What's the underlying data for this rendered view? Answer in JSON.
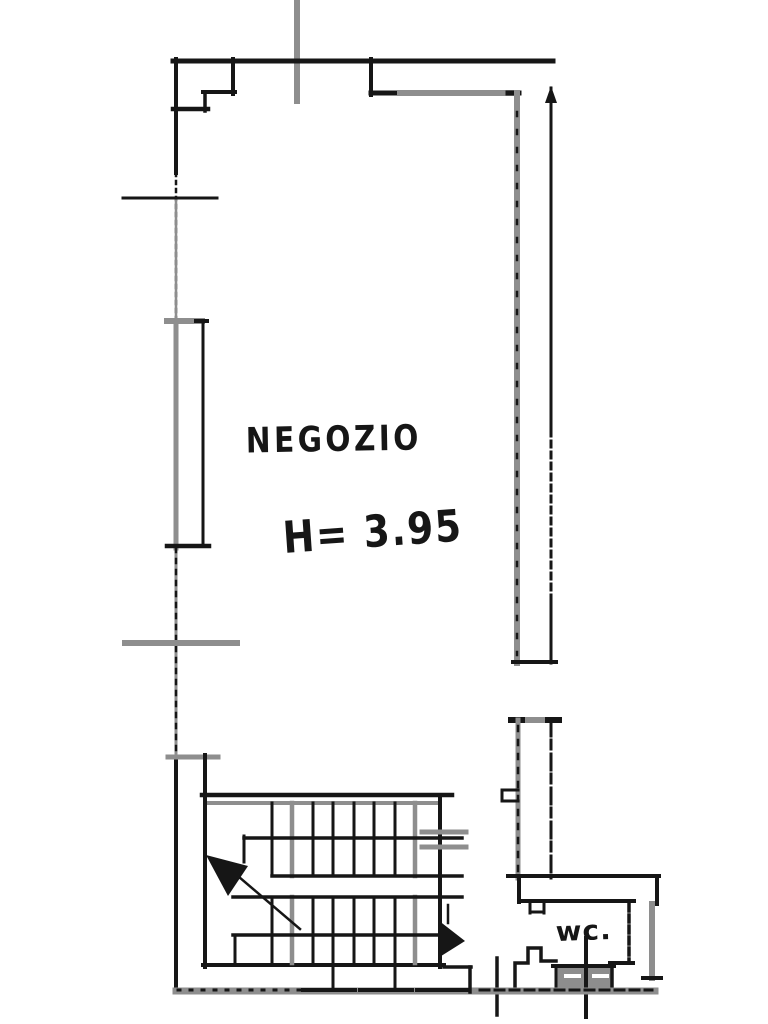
{
  "labels": {
    "room_name": "NEGOZIO",
    "height_note": "H= 3.95",
    "wc_label": "wc."
  },
  "colors": {
    "background": "#ffffff",
    "ink": "#161616",
    "pencil": "#8e8e8e",
    "fixture_fill": "#8d8d8d",
    "white": "#ffffff"
  },
  "floorplan": {
    "canvas": {
      "width": 768,
      "height": 1024
    },
    "rects": [
      {
        "n": "wc-fixture-hatch",
        "x": 556,
        "y": 966,
        "wd": 56,
        "h": 24,
        "f": "fixture_fill"
      }
    ],
    "polylines": [
      {
        "n": "wc-pedestal-outline",
        "pts": "515,992 515,963 528,963 528,948 541,948 541,961 556,961",
        "w": 3.5,
        "c": "ink"
      }
    ],
    "lines": [
      {
        "n": "site-ref-line",
        "x1": 297,
        "y1": 0,
        "x2": 297,
        "y2": 101,
        "w": 6,
        "c": "pencil"
      },
      {
        "n": "top-wall",
        "x1": 173,
        "y1": 61,
        "x2": 553,
        "y2": 61,
        "w": 5,
        "c": "ink"
      },
      {
        "n": "entry-step-v1",
        "x1": 233,
        "y1": 59,
        "x2": 233,
        "y2": 94,
        "w": 4,
        "c": "ink"
      },
      {
        "n": "entry-step-h1",
        "x1": 203,
        "y1": 92,
        "x2": 235,
        "y2": 92,
        "w": 4,
        "c": "ink"
      },
      {
        "n": "entry-step-v2",
        "x1": 205,
        "y1": 92,
        "x2": 205,
        "y2": 111,
        "w": 3.5,
        "c": "ink"
      },
      {
        "n": "entry-step-h2",
        "x1": 173,
        "y1": 109,
        "x2": 208,
        "y2": 109,
        "w": 4.5,
        "c": "ink"
      },
      {
        "n": "left-wall-upper",
        "x1": 176,
        "y1": 59,
        "x2": 176,
        "y2": 173,
        "w": 4,
        "c": "ink"
      },
      {
        "n": "left-wall-upper-dashed",
        "x1": 176,
        "y1": 173,
        "x2": 176,
        "y2": 322,
        "w": 2.5,
        "c": "ink",
        "d": "3,5"
      },
      {
        "n": "left-wall-upper-pencil",
        "x1": 176,
        "y1": 200,
        "x2": 176,
        "y2": 322,
        "w": 2.5,
        "c": "pencil"
      },
      {
        "n": "left-wall-window-run",
        "x1": 176,
        "y1": 322,
        "x2": 176,
        "y2": 548,
        "w": 5,
        "c": "pencil"
      },
      {
        "n": "left-wall-mid-pencil",
        "x1": 176,
        "y1": 548,
        "x2": 176,
        "y2": 758,
        "w": 3,
        "c": "pencil"
      },
      {
        "n": "left-wall-mid-dashed",
        "x1": 176,
        "y1": 548,
        "x2": 176,
        "y2": 758,
        "w": 2.5,
        "c": "ink",
        "d": "4,7"
      },
      {
        "n": "left-wall-lower",
        "x1": 176,
        "y1": 758,
        "x2": 176,
        "y2": 992,
        "w": 4,
        "c": "ink"
      },
      {
        "n": "left-tick-upper",
        "x1": 123,
        "y1": 198,
        "x2": 217,
        "y2": 198,
        "w": 3,
        "c": "ink",
        "d": "7,3,2,3"
      },
      {
        "n": "window-top",
        "x1": 167,
        "y1": 321,
        "x2": 202,
        "y2": 321,
        "w": 6,
        "c": "pencil"
      },
      {
        "n": "window-top-cap",
        "x1": 196,
        "y1": 321,
        "x2": 207,
        "y2": 321,
        "w": 4,
        "c": "ink"
      },
      {
        "n": "window-inner-line",
        "x1": 203,
        "y1": 321,
        "x2": 203,
        "y2": 545,
        "w": 3,
        "c": "ink",
        "d": "6,3"
      },
      {
        "n": "window-bottom",
        "x1": 167,
        "y1": 546,
        "x2": 209,
        "y2": 546,
        "w": 4.5,
        "c": "ink"
      },
      {
        "n": "left-tick-mid",
        "x1": 125,
        "y1": 643,
        "x2": 237,
        "y2": 643,
        "w": 6,
        "c": "pencil"
      },
      {
        "n": "left-tick-lower",
        "x1": 168,
        "y1": 757,
        "x2": 218,
        "y2": 757,
        "w": 5,
        "c": "pencil"
      },
      {
        "n": "left-pier-v",
        "x1": 205,
        "y1": 755,
        "x2": 205,
        "y2": 797,
        "w": 4,
        "c": "ink"
      },
      {
        "n": "top-right-corner-v",
        "x1": 371,
        "y1": 59,
        "x2": 371,
        "y2": 95,
        "w": 4,
        "c": "ink"
      },
      {
        "n": "top-right-wall-ink",
        "x1": 371,
        "y1": 93,
        "x2": 403,
        "y2": 93,
        "w": 5,
        "c": "ink"
      },
      {
        "n": "top-right-wall-pencil",
        "x1": 400,
        "y1": 93,
        "x2": 516,
        "y2": 93,
        "w": 6,
        "c": "pencil"
      },
      {
        "n": "top-right-wall-cap",
        "x1": 508,
        "y1": 93,
        "x2": 519,
        "y2": 93,
        "w": 5,
        "c": "ink"
      },
      {
        "n": "right-inner-wall",
        "x1": 517,
        "y1": 93,
        "x2": 517,
        "y2": 663,
        "w": 6,
        "c": "pencil"
      },
      {
        "n": "right-inner-wall-dashes",
        "x1": 517,
        "y1": 112,
        "x2": 517,
        "y2": 655,
        "w": 2.5,
        "c": "ink",
        "d": "4,14"
      },
      {
        "n": "right-outer-wall-upper",
        "x1": 551,
        "y1": 88,
        "x2": 551,
        "y2": 430,
        "w": 3,
        "c": "ink"
      },
      {
        "n": "right-outer-wall-mid",
        "x1": 551,
        "y1": 430,
        "x2": 551,
        "y2": 600,
        "w": 3,
        "c": "ink",
        "d": "6,5"
      },
      {
        "n": "right-outer-wall-lower",
        "x1": 551,
        "y1": 600,
        "x2": 551,
        "y2": 663,
        "w": 3,
        "c": "ink"
      },
      {
        "n": "right-wall-bottom-cap",
        "x1": 513,
        "y1": 662,
        "x2": 556,
        "y2": 662,
        "w": 4,
        "c": "ink"
      },
      {
        "n": "pilaster-cap",
        "x1": 511,
        "y1": 720,
        "x2": 559,
        "y2": 720,
        "w": 6,
        "c": "pencil"
      },
      {
        "n": "pilaster-cap-left",
        "x1": 511,
        "y1": 720,
        "x2": 522,
        "y2": 720,
        "w": 6,
        "c": "ink"
      },
      {
        "n": "pilaster-cap-right",
        "x1": 548,
        "y1": 720,
        "x2": 559,
        "y2": 720,
        "w": 6,
        "c": "ink"
      },
      {
        "n": "pilaster-left",
        "x1": 518,
        "y1": 720,
        "x2": 518,
        "y2": 878,
        "w": 5,
        "c": "pencil"
      },
      {
        "n": "pilaster-left-dashes",
        "x1": 518,
        "y1": 726,
        "x2": 518,
        "y2": 874,
        "w": 2.5,
        "c": "ink",
        "d": "5,9"
      },
      {
        "n": "pilaster-right",
        "x1": 551,
        "y1": 720,
        "x2": 551,
        "y2": 878,
        "w": 3,
        "c": "ink",
        "d": "16,4,9,5"
      },
      {
        "n": "pilaster-notch-top",
        "x1": 502,
        "y1": 790,
        "x2": 518,
        "y2": 790,
        "w": 3,
        "c": "ink"
      },
      {
        "n": "pilaster-notch-side",
        "x1": 502,
        "y1": 790,
        "x2": 502,
        "y2": 801,
        "w": 3,
        "c": "ink"
      },
      {
        "n": "pilaster-notch-bottom",
        "x1": 502,
        "y1": 801,
        "x2": 518,
        "y2": 801,
        "w": 3,
        "c": "ink"
      },
      {
        "n": "wc-wall-top",
        "x1": 508,
        "y1": 876,
        "x2": 659,
        "y2": 876,
        "w": 4,
        "c": "ink"
      },
      {
        "n": "wc-wall-right-end",
        "x1": 657,
        "y1": 876,
        "x2": 657,
        "y2": 904,
        "w": 4,
        "c": "ink"
      },
      {
        "n": "wc-wall-left-end",
        "x1": 519,
        "y1": 876,
        "x2": 519,
        "y2": 902,
        "w": 4,
        "c": "ink"
      },
      {
        "n": "wc-wall-bottom",
        "x1": 519,
        "y1": 901,
        "x2": 634,
        "y2": 901,
        "w": 4,
        "c": "ink"
      },
      {
        "n": "wc-notch-v1",
        "x1": 530,
        "y1": 901,
        "x2": 530,
        "y2": 913,
        "w": 3,
        "c": "ink"
      },
      {
        "n": "wc-notch-h",
        "x1": 530,
        "y1": 912,
        "x2": 544,
        "y2": 912,
        "w": 3,
        "c": "ink"
      },
      {
        "n": "wc-notch-v2",
        "x1": 544,
        "y1": 901,
        "x2": 544,
        "y2": 913,
        "w": 3,
        "c": "ink"
      },
      {
        "n": "right-lower-wall",
        "x1": 652,
        "y1": 904,
        "x2": 652,
        "y2": 978,
        "w": 6,
        "c": "pencil"
      },
      {
        "n": "right-lower-wall-tick",
        "x1": 643,
        "y1": 978,
        "x2": 661,
        "y2": 978,
        "w": 4,
        "c": "ink"
      },
      {
        "n": "wc-right-wall-dashed",
        "x1": 629,
        "y1": 904,
        "x2": 629,
        "y2": 962,
        "w": 3.5,
        "c": "ink",
        "d": "7,4"
      },
      {
        "n": "wc-bottom-right",
        "x1": 610,
        "y1": 963,
        "x2": 633,
        "y2": 963,
        "w": 4,
        "c": "ink"
      },
      {
        "n": "fixture-top-border",
        "x1": 553,
        "y1": 966,
        "x2": 614,
        "y2": 966,
        "w": 4,
        "c": "ink"
      },
      {
        "n": "fixture-left-border",
        "x1": 556,
        "y1": 966,
        "x2": 556,
        "y2": 990,
        "w": 3,
        "c": "ink"
      },
      {
        "n": "fixture-right-border",
        "x1": 612,
        "y1": 966,
        "x2": 612,
        "y2": 990,
        "w": 3.5,
        "c": "ink"
      },
      {
        "n": "fixture-dash-1",
        "x1": 566,
        "y1": 976,
        "x2": 579,
        "y2": 976,
        "w": 4,
        "c": "white"
      },
      {
        "n": "fixture-dash-2",
        "x1": 594,
        "y1": 976,
        "x2": 607,
        "y2": 976,
        "w": 4,
        "c": "white"
      },
      {
        "n": "wc-door-line",
        "x1": 586,
        "y1": 938,
        "x2": 586,
        "y2": 1017,
        "w": 4,
        "c": "ink"
      },
      {
        "n": "passage-jamb",
        "x1": 497,
        "y1": 958,
        "x2": 497,
        "y2": 1015,
        "w": 3.5,
        "c": "ink"
      },
      {
        "n": "bottom-wall",
        "x1": 176,
        "y1": 991,
        "x2": 655,
        "y2": 991,
        "w": 7,
        "c": "pencil"
      },
      {
        "n": "bottom-wall-ink-left",
        "x1": 178,
        "y1": 990,
        "x2": 300,
        "y2": 990,
        "w": 3,
        "c": "ink",
        "d": "2,10"
      },
      {
        "n": "bottom-wall-ink-mid",
        "x1": 303,
        "y1": 990,
        "x2": 472,
        "y2": 990,
        "w": 4,
        "c": "ink",
        "d": "30,4,18,5"
      },
      {
        "n": "bottom-wall-ink-right",
        "x1": 480,
        "y1": 990,
        "x2": 652,
        "y2": 990,
        "w": 3,
        "c": "ink",
        "d": "9,6"
      },
      {
        "n": "stair-top-wall",
        "x1": 202,
        "y1": 795,
        "x2": 452,
        "y2": 795,
        "w": 4.5,
        "c": "ink"
      },
      {
        "n": "stair-top-wall-pencil",
        "x1": 206,
        "y1": 803,
        "x2": 438,
        "y2": 803,
        "w": 4,
        "c": "pencil"
      },
      {
        "n": "stair-left-wall",
        "x1": 205,
        "y1": 795,
        "x2": 205,
        "y2": 967,
        "w": 4,
        "c": "ink"
      },
      {
        "n": "stair-right-wall",
        "x1": 440,
        "y1": 795,
        "x2": 440,
        "y2": 967,
        "w": 4,
        "c": "ink"
      },
      {
        "n": "stair-bottom-wall",
        "x1": 203,
        "y1": 965,
        "x2": 444,
        "y2": 965,
        "w": 4,
        "c": "ink"
      },
      {
        "n": "stair-bottom-step-h",
        "x1": 444,
        "y1": 967,
        "x2": 471,
        "y2": 967,
        "w": 3.5,
        "c": "ink"
      },
      {
        "n": "stair-bottom-step-v",
        "x1": 470,
        "y1": 967,
        "x2": 470,
        "y2": 992,
        "w": 3.5,
        "c": "ink"
      },
      {
        "n": "stair-tread-u1",
        "x1": 272,
        "y1": 803,
        "x2": 272,
        "y2": 876,
        "w": 3,
        "c": "ink"
      },
      {
        "n": "stair-tread-ug1",
        "x1": 292,
        "y1": 803,
        "x2": 292,
        "y2": 876,
        "w": 4.5,
        "c": "pencil"
      },
      {
        "n": "stair-tread-u2",
        "x1": 313,
        "y1": 803,
        "x2": 313,
        "y2": 876,
        "w": 3,
        "c": "ink"
      },
      {
        "n": "stair-tread-u3",
        "x1": 333,
        "y1": 803,
        "x2": 333,
        "y2": 876,
        "w": 3,
        "c": "ink"
      },
      {
        "n": "stair-tread-u4",
        "x1": 354,
        "y1": 803,
        "x2": 354,
        "y2": 876,
        "w": 3,
        "c": "ink"
      },
      {
        "n": "stair-tread-u5",
        "x1": 374,
        "y1": 803,
        "x2": 374,
        "y2": 876,
        "w": 3,
        "c": "ink"
      },
      {
        "n": "stair-tread-u6",
        "x1": 395,
        "y1": 803,
        "x2": 395,
        "y2": 876,
        "w": 3,
        "c": "ink"
      },
      {
        "n": "stair-tread-ug2",
        "x1": 415,
        "y1": 803,
        "x2": 415,
        "y2": 876,
        "w": 4.5,
        "c": "pencil"
      },
      {
        "n": "stair-tread-l1",
        "x1": 272,
        "y1": 897,
        "x2": 272,
        "y2": 963,
        "w": 3,
        "c": "ink"
      },
      {
        "n": "stair-tread-lg1",
        "x1": 292,
        "y1": 897,
        "x2": 292,
        "y2": 963,
        "w": 4.5,
        "c": "pencil"
      },
      {
        "n": "stair-tread-l2",
        "x1": 313,
        "y1": 897,
        "x2": 313,
        "y2": 963,
        "w": 3,
        "c": "ink"
      },
      {
        "n": "stair-tread-l3",
        "x1": 333,
        "y1": 897,
        "x2": 333,
        "y2": 963,
        "w": 3,
        "c": "ink"
      },
      {
        "n": "stair-tread-l4",
        "x1": 354,
        "y1": 897,
        "x2": 354,
        "y2": 963,
        "w": 3,
        "c": "ink"
      },
      {
        "n": "stair-tread-l5",
        "x1": 374,
        "y1": 897,
        "x2": 374,
        "y2": 963,
        "w": 3,
        "c": "ink"
      },
      {
        "n": "stair-tread-l6",
        "x1": 395,
        "y1": 897,
        "x2": 395,
        "y2": 963,
        "w": 3,
        "c": "ink"
      },
      {
        "n": "stair-tread-lg2",
        "x1": 415,
        "y1": 897,
        "x2": 415,
        "y2": 963,
        "w": 4.5,
        "c": "pencil"
      },
      {
        "n": "stair-tread-ext-1",
        "x1": 333,
        "y1": 963,
        "x2": 333,
        "y2": 990,
        "w": 3,
        "c": "ink"
      },
      {
        "n": "stair-tread-ext-2",
        "x1": 395,
        "y1": 963,
        "x2": 395,
        "y2": 988,
        "w": 3,
        "c": "ink"
      },
      {
        "n": "stair-rail-upper",
        "x1": 244,
        "y1": 838,
        "x2": 462,
        "y2": 838,
        "w": 3.5,
        "c": "ink"
      },
      {
        "n": "stair-rail-newel",
        "x1": 244,
        "y1": 836,
        "x2": 244,
        "y2": 862,
        "w": 3,
        "c": "ink"
      },
      {
        "n": "stair-tick-gray-1",
        "x1": 422,
        "y1": 832,
        "x2": 466,
        "y2": 832,
        "w": 5,
        "c": "pencil"
      },
      {
        "n": "stair-tick-gray-2",
        "x1": 422,
        "y1": 847,
        "x2": 466,
        "y2": 847,
        "w": 5,
        "c": "pencil"
      },
      {
        "n": "stair-landing-top",
        "x1": 272,
        "y1": 876,
        "x2": 462,
        "y2": 876,
        "w": 3.5,
        "c": "ink"
      },
      {
        "n": "stair-landing-bottom",
        "x1": 233,
        "y1": 897,
        "x2": 462,
        "y2": 897,
        "w": 3.5,
        "c": "ink"
      },
      {
        "n": "stair-rail-lower",
        "x1": 233,
        "y1": 935,
        "x2": 444,
        "y2": 935,
        "w": 3.5,
        "c": "ink"
      },
      {
        "n": "stair-rail-lower-v",
        "x1": 235,
        "y1": 935,
        "x2": 235,
        "y2": 965,
        "w": 3,
        "c": "ink"
      },
      {
        "n": "stair-arrow-shaft",
        "x1": 300,
        "y1": 929,
        "x2": 232,
        "y2": 871,
        "w": 2.5,
        "c": "ink"
      },
      {
        "n": "stair-arrow2-shaft",
        "x1": 448,
        "y1": 905,
        "x2": 448,
        "y2": 923,
        "w": 2.5,
        "c": "ink"
      }
    ],
    "polygons": [
      {
        "n": "right-wall-arrowhead",
        "pts": "545,103 557,103 551,86",
        "c": "ink"
      },
      {
        "n": "stair-down-arrowhead",
        "pts": "206,855 248,866 228,896",
        "c": "ink"
      },
      {
        "n": "stair-exit-arrowhead",
        "pts": "438,920 438,958 465,941",
        "c": "ink"
      }
    ]
  }
}
